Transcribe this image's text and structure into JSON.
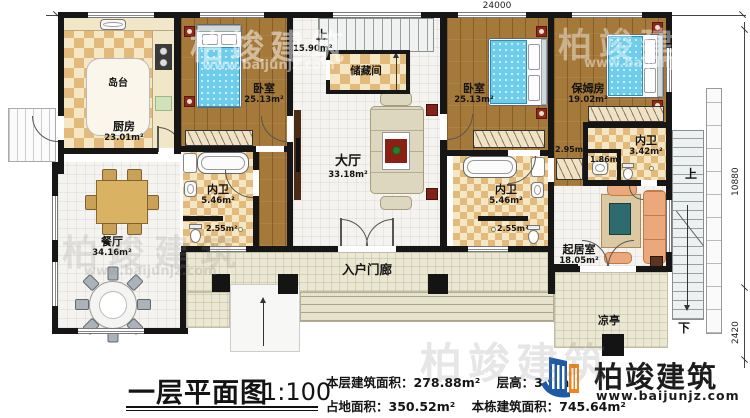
{
  "dimensions": {
    "top_width": "24000",
    "right_height": "10880",
    "right_depth": "2420"
  },
  "stairs": {
    "up_label": "上",
    "down_label": "下",
    "stairwell_area": "15.90m²"
  },
  "rooms": {
    "kitchen": {
      "name": "厨房",
      "area": "23.01m²"
    },
    "island": {
      "name": "岛台"
    },
    "bedroom_left": {
      "name": "卧室",
      "area": "25.13m²"
    },
    "storage": {
      "name": "储藏间"
    },
    "bedroom_center": {
      "name": "卧室",
      "area": "25.13m²"
    },
    "nanny_room": {
      "name": "保姆房",
      "area": "19.02m²"
    },
    "hall": {
      "name": "大厅",
      "area": "33.18m²"
    },
    "bath_left": {
      "name": "内卫",
      "area": "5.46m²"
    },
    "wc_left": {
      "area": "2.55m²"
    },
    "bath_center": {
      "name": "内卫",
      "area": "5.46m²"
    },
    "wc_center": {
      "area": "2.55m²"
    },
    "bath_right": {
      "name": "内卫",
      "area": "3.42m²"
    },
    "washroom_right": {
      "area": "1.86m²"
    },
    "closet_right": {
      "area": "2.95m²"
    },
    "living_room": {
      "name": "起居室",
      "area": "18.05m²"
    },
    "dining_room": {
      "name": "餐厅",
      "area": "34.16m²"
    },
    "entry_porch": {
      "name": "入户门廊"
    },
    "pavilion": {
      "name": "凉亭"
    }
  },
  "title_block": {
    "title": "一层平面图",
    "scale": "1:100",
    "stats": [
      {
        "label": "本层建筑面积：",
        "value": "278.88m²"
      },
      {
        "label": "层高：",
        "value": "3.9m"
      },
      {
        "label": "占地面积：",
        "value": "350.52m²"
      },
      {
        "label": "本栋建筑面积：",
        "value": "745.64m²"
      }
    ]
  },
  "logo": {
    "brand": "柏竣建筑",
    "url": "www.baijunjz.com"
  },
  "watermark": {
    "text": "柏竣建筑",
    "url": "www.baijunjz.com"
  }
}
